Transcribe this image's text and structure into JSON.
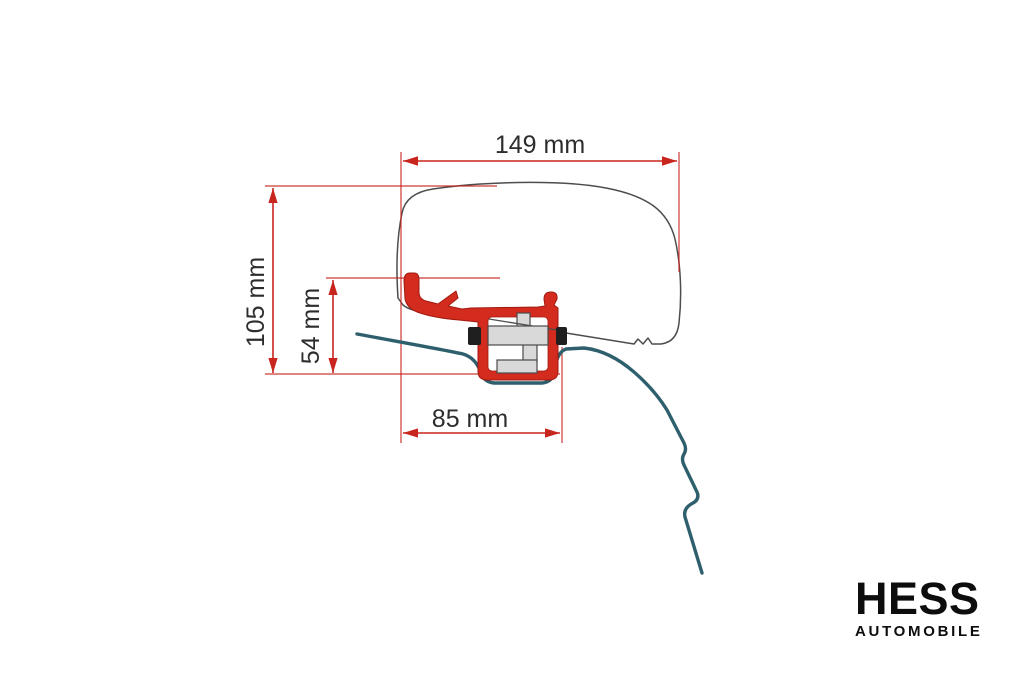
{
  "diagram": {
    "dims": {
      "top_width": "149 mm",
      "total_height": "105 mm",
      "inner_height": "54 mm",
      "bottom_width": "85 mm"
    },
    "colors": {
      "dimension_red": "#c8251f",
      "bracket_red": "#d32b1e",
      "roof_teal": "#2e5f6d",
      "outline_gray": "#4d4d4d",
      "background": "#ffffff"
    }
  },
  "logo": {
    "name": "HESS",
    "subtitle": "AUTOMOBILE"
  }
}
